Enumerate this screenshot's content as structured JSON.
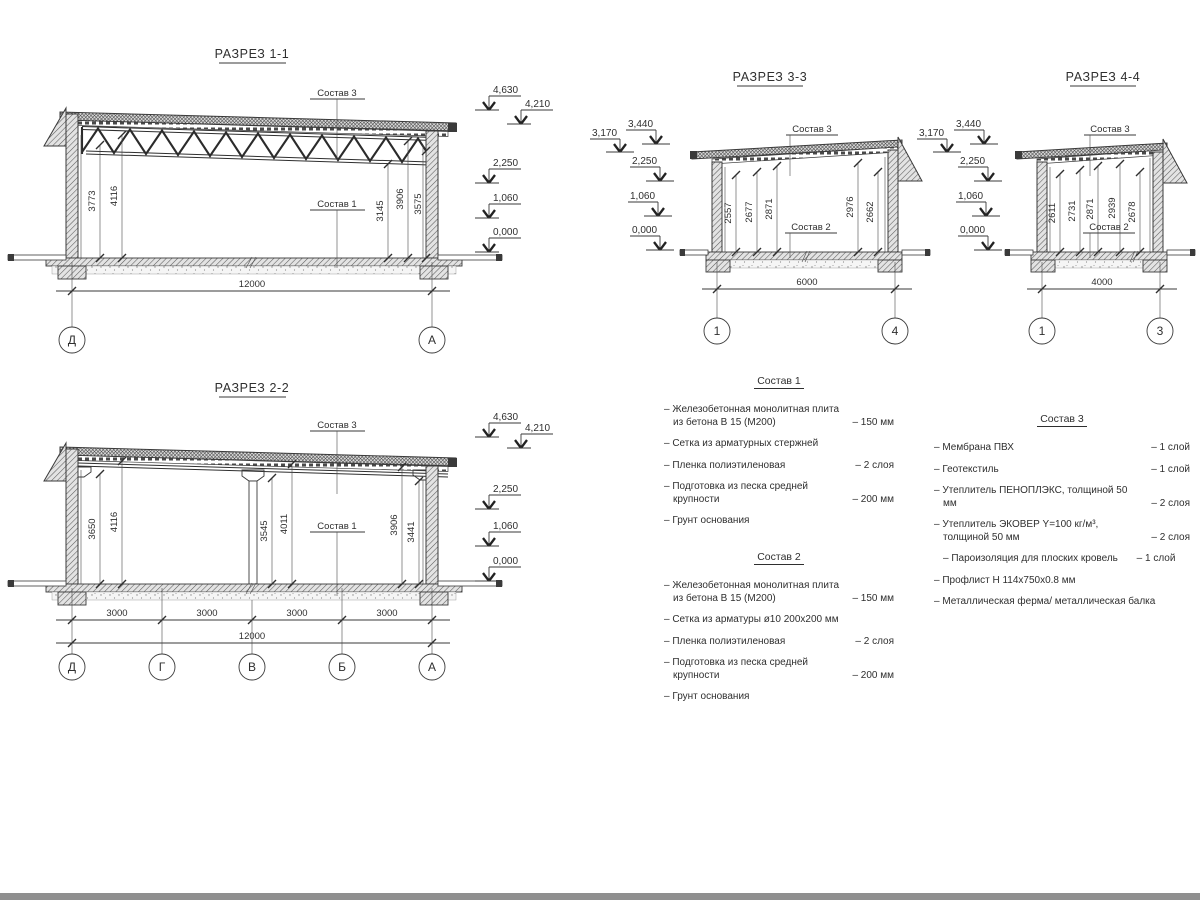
{
  "page": {
    "background": "#ffffff",
    "line_color": "#3a3a3a",
    "bottom_bar_color": "#8f8f8f"
  },
  "sections": {
    "s11": {
      "title": "РАЗРЕЗ 1-1",
      "label_top": "Состав 3",
      "label_bottom": "Состав 1",
      "dims": [
        "3773",
        "4116",
        "3145",
        "3906",
        "3575"
      ],
      "elevs": [
        "4,630",
        "4,210",
        "2,250",
        "1,060",
        "0,000"
      ],
      "total": "12000",
      "axes": [
        "Д",
        "А"
      ]
    },
    "s22": {
      "title": "РАЗРЕЗ 2-2",
      "label_top": "Состав 3",
      "label_bottom": "Состав 1",
      "dims": [
        "3650",
        "4116",
        "3545",
        "4011",
        "3906",
        "3441"
      ],
      "elevs": [
        "4,630",
        "4,210",
        "2,250",
        "1,060",
        "0,000"
      ],
      "spans": [
        "3000",
        "3000",
        "3000",
        "3000"
      ],
      "total": "12000",
      "axes": [
        "Д",
        "Г",
        "В",
        "Б",
        "А"
      ]
    },
    "s33": {
      "title": "РАЗРЕЗ 3-3",
      "label_top": "Состав 3",
      "label_bottom": "Состав 2",
      "dims": [
        "2557",
        "2677",
        "2871",
        "2976",
        "2662"
      ],
      "elevs": [
        "3,170",
        "3,440",
        "2,250",
        "1,060",
        "0,000"
      ],
      "total": "6000",
      "axes": [
        "1",
        "4"
      ]
    },
    "s44": {
      "title": "РАЗРЕЗ 4-4",
      "label_top": "Состав 3",
      "label_bottom": "Состав 2",
      "dims": [
        "2611",
        "2731",
        "2871",
        "2939",
        "2678"
      ],
      "elevs": [
        "3,170",
        "3,440",
        "2,250",
        "1,060",
        "0,000"
      ],
      "total": "4000",
      "axes": [
        "1",
        "3"
      ]
    }
  },
  "compositions": [
    {
      "title": "Состав 1",
      "items": [
        {
          "text": "– Железобетонная  монолитная плита из бетона В 15 (М200)",
          "qty": "– 150 мм"
        },
        {
          "text": "– Сетка из арматурных стержней",
          "qty": ""
        },
        {
          "text": "– Пленка полиэтиленовая",
          "qty": "– 2 слоя"
        },
        {
          "text": "– Подготовка из песка средней крупности",
          "qty": "– 200 мм"
        },
        {
          "text": "– Грунт основания",
          "qty": ""
        }
      ]
    },
    {
      "title": "Состав 2",
      "items": [
        {
          "text": "– Железобетонная  монолитная плита из бетона В 15 (М200)",
          "qty": "– 150 мм"
        },
        {
          "text": "– Сетка из арматуры ø10 200x200 мм",
          "qty": ""
        },
        {
          "text": "– Пленка полиэтиленовая",
          "qty": "– 2 слоя"
        },
        {
          "text": "– Подготовка из песка средней крупности",
          "qty": "– 200 мм"
        },
        {
          "text": "– Грунт основания",
          "qty": ""
        }
      ]
    },
    {
      "title": "Состав 3",
      "items": [
        {
          "text": "– Мембрана ПВХ",
          "qty": "– 1 слой"
        },
        {
          "text": "– Геотекстиль",
          "qty": "– 1 слой"
        },
        {
          "text": "– Утеплитель ПЕНОПЛЭКС, толщиной 50 мм",
          "qty": "– 2 слоя"
        },
        {
          "text": "– Утеплитель ЭКОВЕР Y=100 кг/м³, толщиной 50 мм",
          "qty": "– 2 слоя"
        },
        {
          "text": "– Пароизоляция для плоских кровель",
          "qty": "– 1 слой"
        },
        {
          "text": "– Профлист Н 114x750x0.8 мм",
          "qty": ""
        },
        {
          "text": "– Металлическая ферма/ металлическая балка",
          "qty": ""
        }
      ]
    }
  ]
}
